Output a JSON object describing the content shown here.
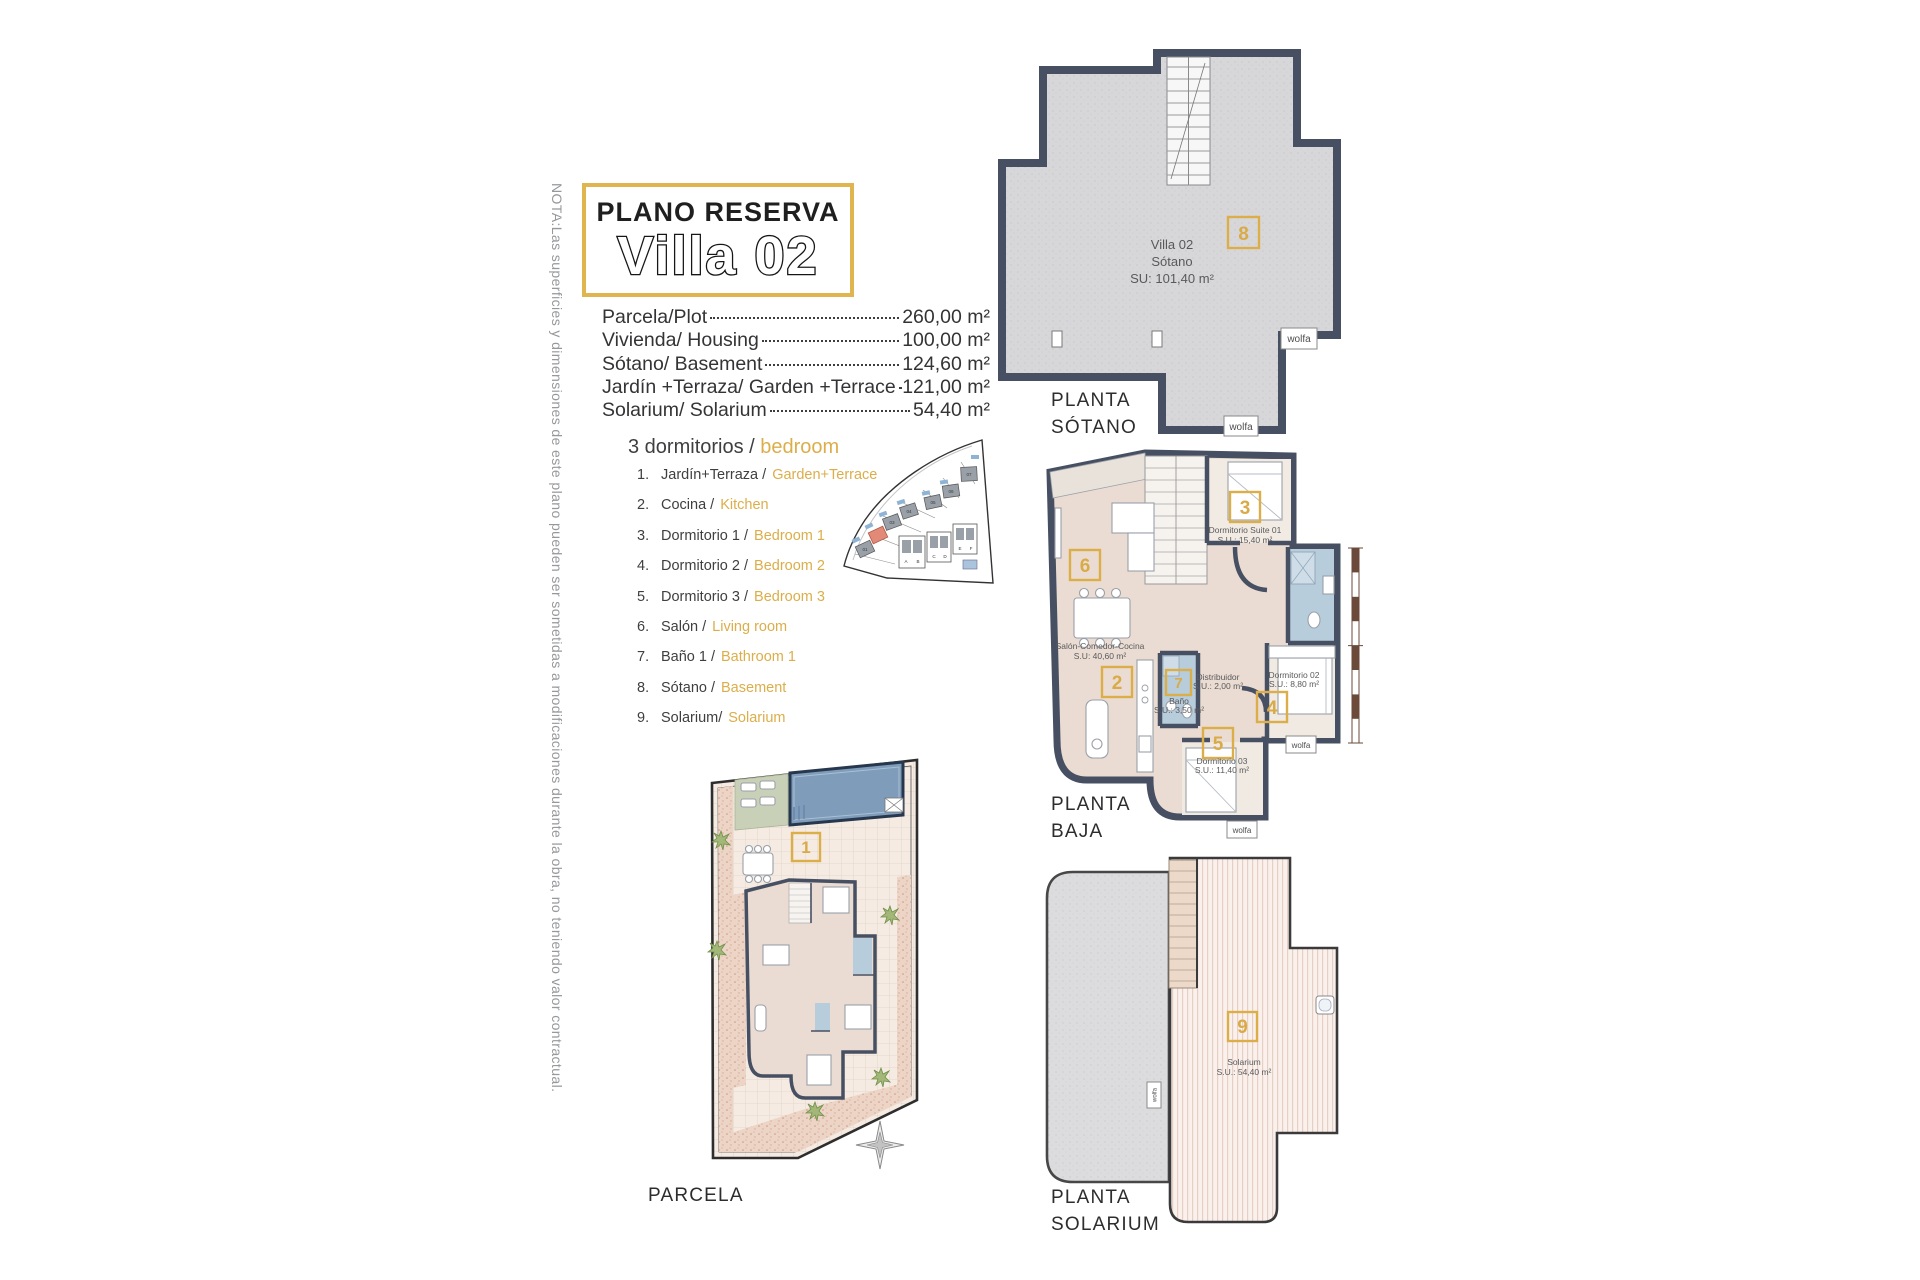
{
  "note_vertical": "NOTA:Las superficies y dimensiones de este plano pueden ser sometidas a modificaciones durante la obra, no teniendo valor contractual.",
  "title": {
    "subtitle": "PLANO RESERVA",
    "main": "Villa 02"
  },
  "measurements": [
    {
      "label": "Parcela/Plot",
      "value": "260,00 m²"
    },
    {
      "label": "Vivienda/ Housing",
      "value": "100,00 m²"
    },
    {
      "label": "Sótano/ Basement",
      "value": "124,60 m²"
    },
    {
      "label": "Jardín +Terraza/ Garden +Terrace",
      "value": "121,00 m²"
    },
    {
      "label": "Solarium/ Solarium",
      "value": "54,40 m²"
    }
  ],
  "legend": {
    "header_es": "3 dormitorios /",
    "header_en": "bedroom",
    "items": [
      {
        "num": "1.",
        "es": "Jardín+Terraza /",
        "en": "Garden+Terrace"
      },
      {
        "num": "2.",
        "es": "Cocina /",
        "en": "Kitchen"
      },
      {
        "num": "3.",
        "es": "Dormitorio 1 /",
        "en": "Bedroom 1"
      },
      {
        "num": "4.",
        "es": "Dormitorio 2 /",
        "en": "Bedroom 2"
      },
      {
        "num": "5.",
        "es": "Dormitorio 3 /",
        "en": "Bedroom 3"
      },
      {
        "num": "6.",
        "es": "Salón /",
        "en": "Living room"
      },
      {
        "num": "7.",
        "es": "Baño 1 /",
        "en": "Bathroom 1"
      },
      {
        "num": "8.",
        "es": "Sótano /",
        "en": "Basement"
      },
      {
        "num": "9.",
        "es": "Solarium/",
        "en": "Solarium"
      }
    ]
  },
  "site_plan": {
    "plots": [
      "01",
      "03",
      "04",
      "05",
      "06",
      "07"
    ],
    "townhouses": [
      "A",
      "B",
      "C",
      "D",
      "E",
      "F"
    ]
  },
  "plans": {
    "sotano": {
      "caption_line1": "PLANTA",
      "caption_line2": "SÓTANO",
      "badge": "8",
      "room_line1": "Villa 02",
      "room_line2": "Sótano",
      "room_line3": "SU: 101,40 m²",
      "logo": "wolfa"
    },
    "baja": {
      "caption_line1": "PLANTA",
      "caption_line2": "BAJA",
      "logo": "wolfa",
      "badges": {
        "living": "6",
        "kitchen": "2",
        "suite": "3",
        "dorm2": "4",
        "dorm3": "5",
        "bath": "7"
      },
      "rooms": {
        "living_name": "Salón-Comedor-Cocina",
        "living_area": "S.U: 40,60 m²",
        "suite_name": "Dormitorio Suite 01",
        "suite_area": "S.U.: 15,40 m²",
        "distribuidor_name": "Distribuidor",
        "distribuidor_area": "S.U.: 2,00 m²",
        "bath_name": "Baño",
        "bath_area": "S.U.: 3,50 m²",
        "dorm2_name": "Dormitorio 02",
        "dorm2_area": "S.U.: 8,80 m²",
        "dorm3_name": "Dormitorio 03",
        "dorm3_area": "S.U.: 11,40 m²"
      }
    },
    "parcela": {
      "caption": "PARCELA",
      "badge": "1"
    },
    "solarium": {
      "caption_line1": "PLANTA",
      "caption_line2": "SOLARIUM",
      "badge": "9",
      "room_name": "Solarium",
      "room_area": "S.U.: 54,40 m²",
      "logo": "wolfa"
    }
  },
  "colors": {
    "accent_gold": "#dcae4a",
    "wall": "#475062",
    "bath_blue": "#b7cddc",
    "floor_beige": "#eadcd2",
    "basement_gray": "#d7d7d9",
    "pool_blue": "#7f9cba",
    "lawn_green": "#c9d0b8",
    "highlight_red": "#e28977",
    "text_dark": "#3c3c3e",
    "text_gray": "#96989b"
  }
}
